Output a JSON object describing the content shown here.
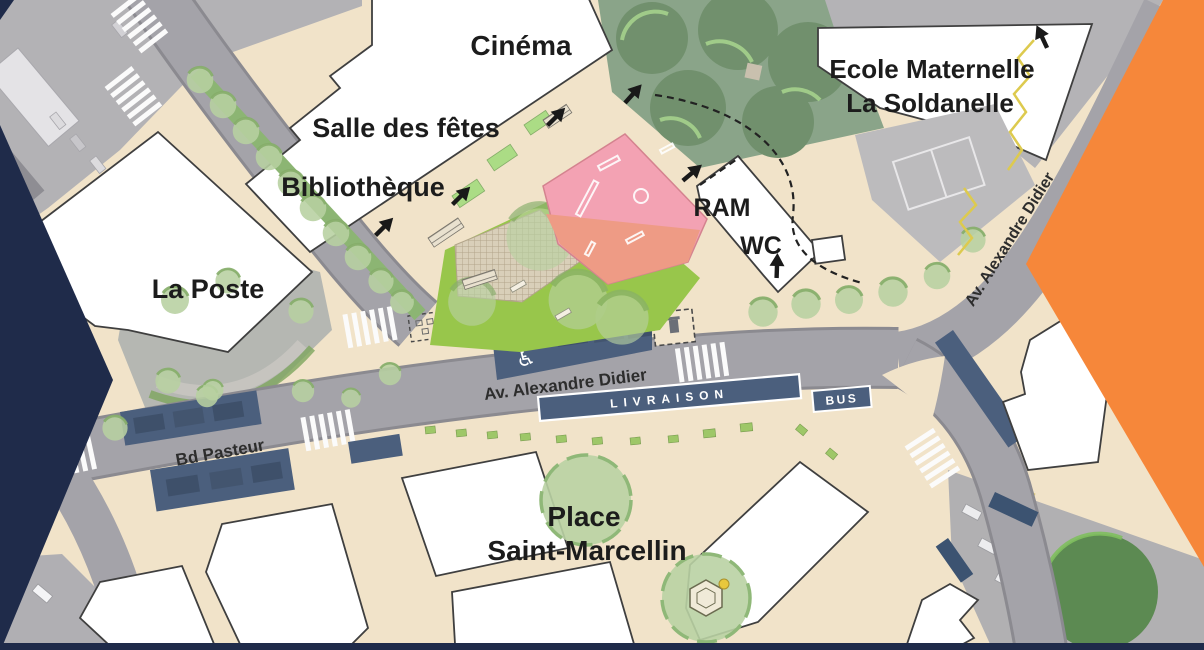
{
  "map": {
    "building_labels": {
      "cinema": "Cinéma",
      "salle_des_fetes": "Salle des fêtes",
      "bibliotheque": "Bibliothèque",
      "la_poste": "La Poste",
      "ecole_line1": "Ecole Maternelle",
      "ecole_line2": "La Soldanelle",
      "ram": "RAM",
      "wc": "WC",
      "place_line1": "Place",
      "place_line2": "Saint-Marcellin"
    },
    "street_labels": {
      "av_alexandre_didier": "Av. Alexandre Didier",
      "av_alexandre_didier_nord": "Av. Alexandre Didier",
      "bd_pasteur": "Bd Pasteur"
    },
    "road_zone_labels": {
      "livraison": "LIVRAISON",
      "bus": "BUS"
    },
    "icons": {
      "accessible_parking_icon": "♿"
    },
    "colors": {
      "navy": "#1f2b4a",
      "orange": "#f6873a",
      "plan_beige": "#f1e3c9",
      "road_gray": "#a4a3a9",
      "aerial_gray": "#b3b2b5",
      "parking_navy": "#4b5f7d",
      "lawn_green": "#98c64b",
      "tree_green": "#b7d0a0",
      "park_green": "#8aa489",
      "highlight_pink": "#f3a2b3",
      "highlight_salmon": "#ee9b85",
      "building_white": "#ffffff"
    }
  }
}
